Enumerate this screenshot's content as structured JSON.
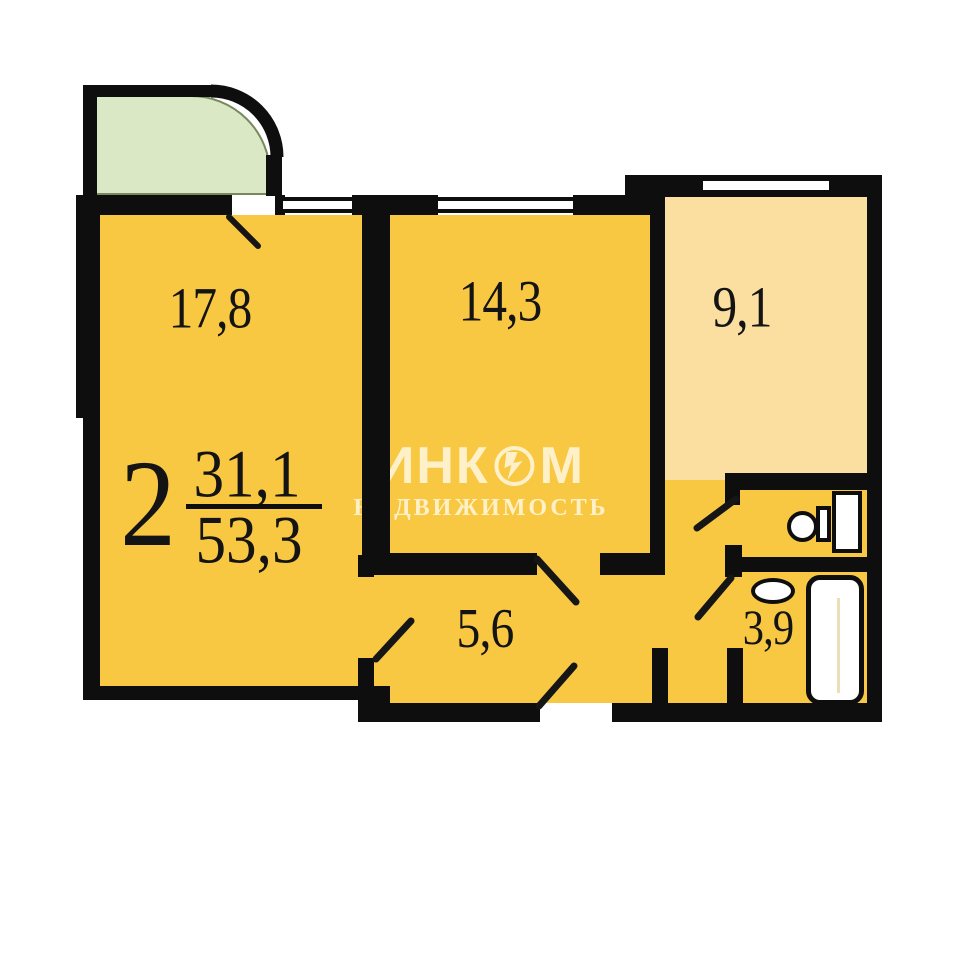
{
  "apartment": {
    "rooms_count": "2",
    "living_area": "31,1",
    "total_area": "53,3"
  },
  "room_labels": {
    "room_a": "17,8",
    "room_b": "14,3",
    "room_c": "9,1",
    "corridor": "5,6",
    "bathroom": "3,9"
  },
  "watermark": {
    "brand_full": "ИНКОМ",
    "brand_left": "ИНК",
    "brand_right": "М",
    "subtitle": "НЕДВИЖИМОСТЬ"
  },
  "icons": {
    "logo": "inkom-circle-bolt-icon",
    "toilet": "toilet-icon",
    "sink": "sink-icon",
    "bathtub": "bathtub-icon",
    "windows": "window-symbol",
    "doors": "door-swing-arc"
  },
  "colors": {
    "wall": "#0e0e0e",
    "room_yellow": "#f9c843",
    "room_pale_yellow": "#fadfa0",
    "balcony_green": "#dbe8c5",
    "watermark_cream": "#fff9e4",
    "background": "#ffffff"
  }
}
